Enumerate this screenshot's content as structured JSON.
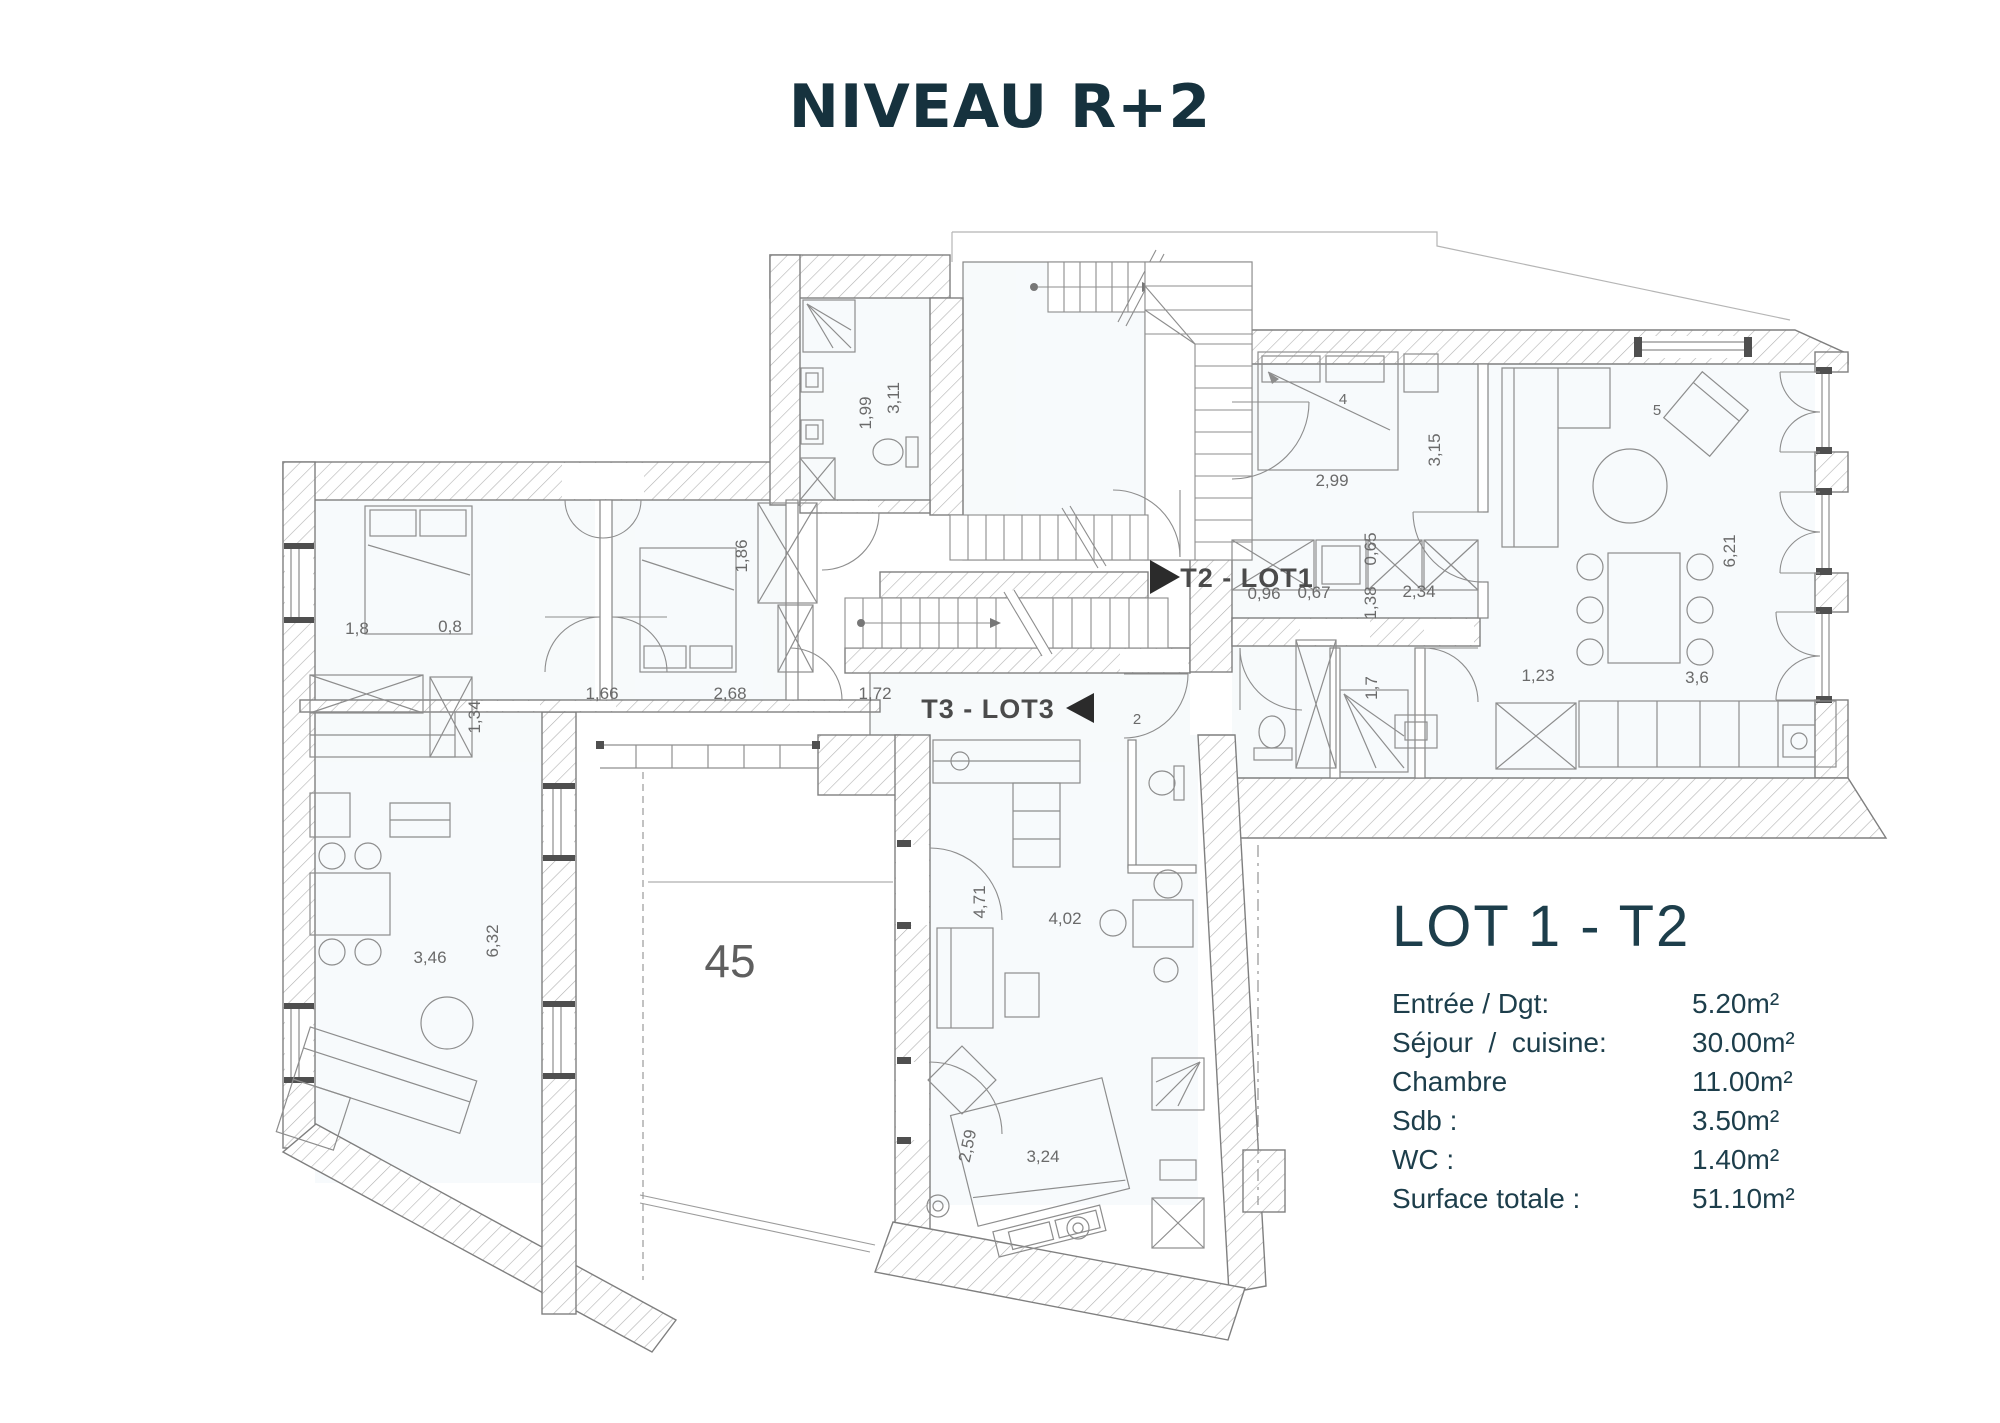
{
  "title": "NIVEAU R+2",
  "plan": {
    "unit_labels": {
      "lot1": "T2 - LOT1",
      "lot3": "T3 - LOT3"
    },
    "room_number": "45",
    "door_tag": "2",
    "furniture_tags": {
      "bed": "4",
      "chair": "5"
    },
    "dimensions": [
      "1,99",
      "3,11",
      "1,8",
      "0,8",
      "1,86",
      "1,66",
      "2,68",
      "1,72",
      "1,34",
      "3,46",
      "6,32",
      "4,71",
      "4,02",
      "2,59",
      "3,24",
      "2,99",
      "3,15",
      "0,65",
      "1,38",
      "0,96",
      "0,67",
      "2,34",
      "1,7",
      "1,23",
      "3,6",
      "6,21"
    ]
  },
  "lot_panel": {
    "title": "LOT 1 - T2",
    "rows": [
      {
        "label": "Entrée / Dgt:",
        "value": "5.20m²"
      },
      {
        "label": "Séjour  /  cuisine:",
        "value": "30.00m²"
      },
      {
        "label": "Chambre",
        "value": "11.00m²"
      },
      {
        "label": "Sdb :",
        "value": "3.50m²"
      },
      {
        "label": "WC :",
        "value": "1.40m²"
      },
      {
        "label": "Surface totale :",
        "value": "51.10m²"
      }
    ]
  },
  "colors": {
    "accent": "#16323e",
    "line": "#8a8a8a"
  }
}
